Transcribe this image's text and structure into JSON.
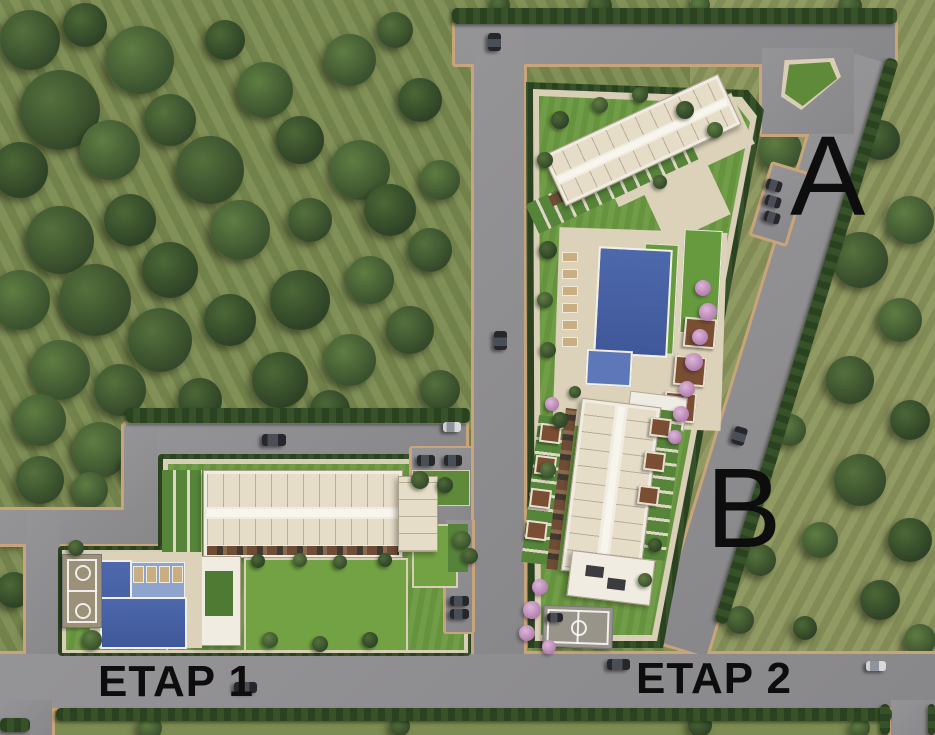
{
  "labels": {
    "block_a": "A",
    "block_b": "B",
    "phase_1": "ETAP 1",
    "phase_2": "ETAP 2"
  },
  "palette": {
    "forest": "#78894f",
    "field": "#87915a",
    "tree_dark": "#34492a",
    "road": "#8f8e91",
    "curb": "#c7a479",
    "hedge": "#2a421f",
    "parcel_lawn": "#699840",
    "path": "#d9ceb6",
    "deck": "#dcd2ba",
    "building_roof": "#f0ece1",
    "unit_terrace": "#e6ddc9",
    "pool_blue": "#4d68ac",
    "pool_shallow": "#8ea4cd",
    "pink_tree": "#c99bc4",
    "label_text": "#0d0d0d",
    "car_dark": "#26262b",
    "car_light": "#cfd0d2"
  },
  "terrain_trees": [
    [
      30,
      40,
      30
    ],
    [
      85,
      25,
      22
    ],
    [
      140,
      60,
      34
    ],
    [
      60,
      110,
      40
    ],
    [
      20,
      170,
      28
    ],
    [
      110,
      150,
      30
    ],
    [
      170,
      120,
      26
    ],
    [
      225,
      40,
      20
    ],
    [
      265,
      90,
      28
    ],
    [
      210,
      170,
      34
    ],
    [
      300,
      140,
      24
    ],
    [
      350,
      60,
      26
    ],
    [
      395,
      30,
      18
    ],
    [
      420,
      100,
      22
    ],
    [
      360,
      170,
      30
    ],
    [
      60,
      240,
      34
    ],
    [
      130,
      220,
      26
    ],
    [
      20,
      300,
      30
    ],
    [
      95,
      300,
      36
    ],
    [
      170,
      270,
      28
    ],
    [
      240,
      230,
      30
    ],
    [
      310,
      220,
      22
    ],
    [
      390,
      210,
      26
    ],
    [
      440,
      180,
      20
    ],
    [
      160,
      340,
      32
    ],
    [
      230,
      320,
      26
    ],
    [
      60,
      370,
      30
    ],
    [
      120,
      390,
      26
    ],
    [
      300,
      300,
      30
    ],
    [
      370,
      280,
      24
    ],
    [
      430,
      250,
      22
    ],
    [
      280,
      380,
      28
    ],
    [
      350,
      360,
      26
    ],
    [
      410,
      330,
      24
    ],
    [
      200,
      400,
      22
    ],
    [
      40,
      420,
      26
    ],
    [
      440,
      390,
      20
    ],
    [
      330,
      410,
      20
    ],
    [
      100,
      450,
      28
    ],
    [
      40,
      480,
      24
    ],
    [
      140,
      470,
      20
    ],
    [
      90,
      490,
      18
    ],
    [
      15,
      530,
      16
    ],
    [
      14,
      590,
      18
    ],
    [
      40,
      628,
      14
    ],
    [
      500,
      5,
      10
    ],
    [
      600,
      6,
      12
    ],
    [
      700,
      5,
      10
    ],
    [
      850,
      6,
      12
    ],
    [
      730,
      120,
      18
    ],
    [
      780,
      150,
      22
    ],
    [
      830,
      180,
      26
    ],
    [
      880,
      140,
      20
    ],
    [
      910,
      220,
      24
    ],
    [
      860,
      260,
      28
    ],
    [
      800,
      300,
      20
    ],
    [
      900,
      320,
      22
    ],
    [
      850,
      380,
      24
    ],
    [
      910,
      420,
      20
    ],
    [
      790,
      430,
      16
    ],
    [
      860,
      480,
      26
    ],
    [
      910,
      540,
      22
    ],
    [
      820,
      540,
      18
    ],
    [
      760,
      560,
      16
    ],
    [
      880,
      600,
      20
    ],
    [
      920,
      640,
      16
    ],
    [
      740,
      620,
      14
    ],
    [
      805,
      628,
      12
    ],
    [
      150,
      728,
      12
    ],
    [
      400,
      726,
      10
    ],
    [
      700,
      725,
      12
    ],
    [
      860,
      728,
      10
    ]
  ],
  "parcel_trees": [
    [
      420,
      480,
      9
    ],
    [
      445,
      485,
      8
    ],
    [
      462,
      540,
      9
    ],
    [
      470,
      556,
      8
    ],
    [
      258,
      561,
      7
    ],
    [
      300,
      560,
      7
    ],
    [
      340,
      562,
      7
    ],
    [
      385,
      560,
      7
    ],
    [
      270,
      640,
      8
    ],
    [
      320,
      644,
      8
    ],
    [
      370,
      640,
      8
    ],
    [
      92,
      640,
      10
    ],
    [
      76,
      548,
      8
    ],
    [
      560,
      120,
      9
    ],
    [
      600,
      105,
      8
    ],
    [
      640,
      95,
      8
    ],
    [
      685,
      110,
      9
    ],
    [
      715,
      130,
      8
    ],
    [
      545,
      160,
      8
    ],
    [
      548,
      250,
      9
    ],
    [
      545,
      300,
      8
    ],
    [
      548,
      350,
      8
    ],
    [
      560,
      420,
      8
    ],
    [
      548,
      470,
      8
    ],
    [
      660,
      182,
      7
    ],
    [
      655,
      545,
      7
    ],
    [
      645,
      580,
      7
    ],
    [
      575,
      392,
      6
    ]
  ],
  "pink_trees": [
    [
      703,
      288,
      8
    ],
    [
      708,
      312,
      9
    ],
    [
      700,
      337,
      8
    ],
    [
      694,
      362,
      9
    ],
    [
      687,
      389,
      8
    ],
    [
      681,
      414,
      8
    ],
    [
      675,
      437,
      7
    ],
    [
      552,
      404,
      7
    ],
    [
      540,
      587,
      8
    ],
    [
      532,
      610,
      9
    ],
    [
      527,
      633,
      8
    ],
    [
      549,
      647,
      7
    ]
  ],
  "cars": [
    [
      488,
      33,
      13,
      18,
      0,
      "darkV"
    ],
    [
      766,
      180,
      16,
      11,
      17,
      "dark"
    ],
    [
      765,
      196,
      16,
      11,
      17,
      "dark"
    ],
    [
      764,
      212,
      16,
      11,
      17,
      "dark"
    ],
    [
      494,
      331,
      13,
      19,
      0,
      "darkV"
    ],
    [
      733,
      427,
      13,
      18,
      17,
      "darkV"
    ],
    [
      262,
      434,
      24,
      12,
      0,
      "dark"
    ],
    [
      443,
      422,
      18,
      10,
      0,
      "light"
    ],
    [
      417,
      455,
      18,
      11,
      0,
      "dark"
    ],
    [
      444,
      455,
      18,
      11,
      0,
      "dark"
    ],
    [
      450,
      596,
      19,
      10,
      0,
      "dark"
    ],
    [
      450,
      609,
      19,
      10,
      0,
      "dark"
    ],
    [
      234,
      682,
      23,
      11,
      0,
      "dark"
    ],
    [
      607,
      659,
      23,
      11,
      0,
      "dark"
    ],
    [
      866,
      661,
      20,
      10,
      0,
      "light"
    ],
    [
      547,
      613,
      16,
      9,
      0,
      "dark"
    ]
  ]
}
